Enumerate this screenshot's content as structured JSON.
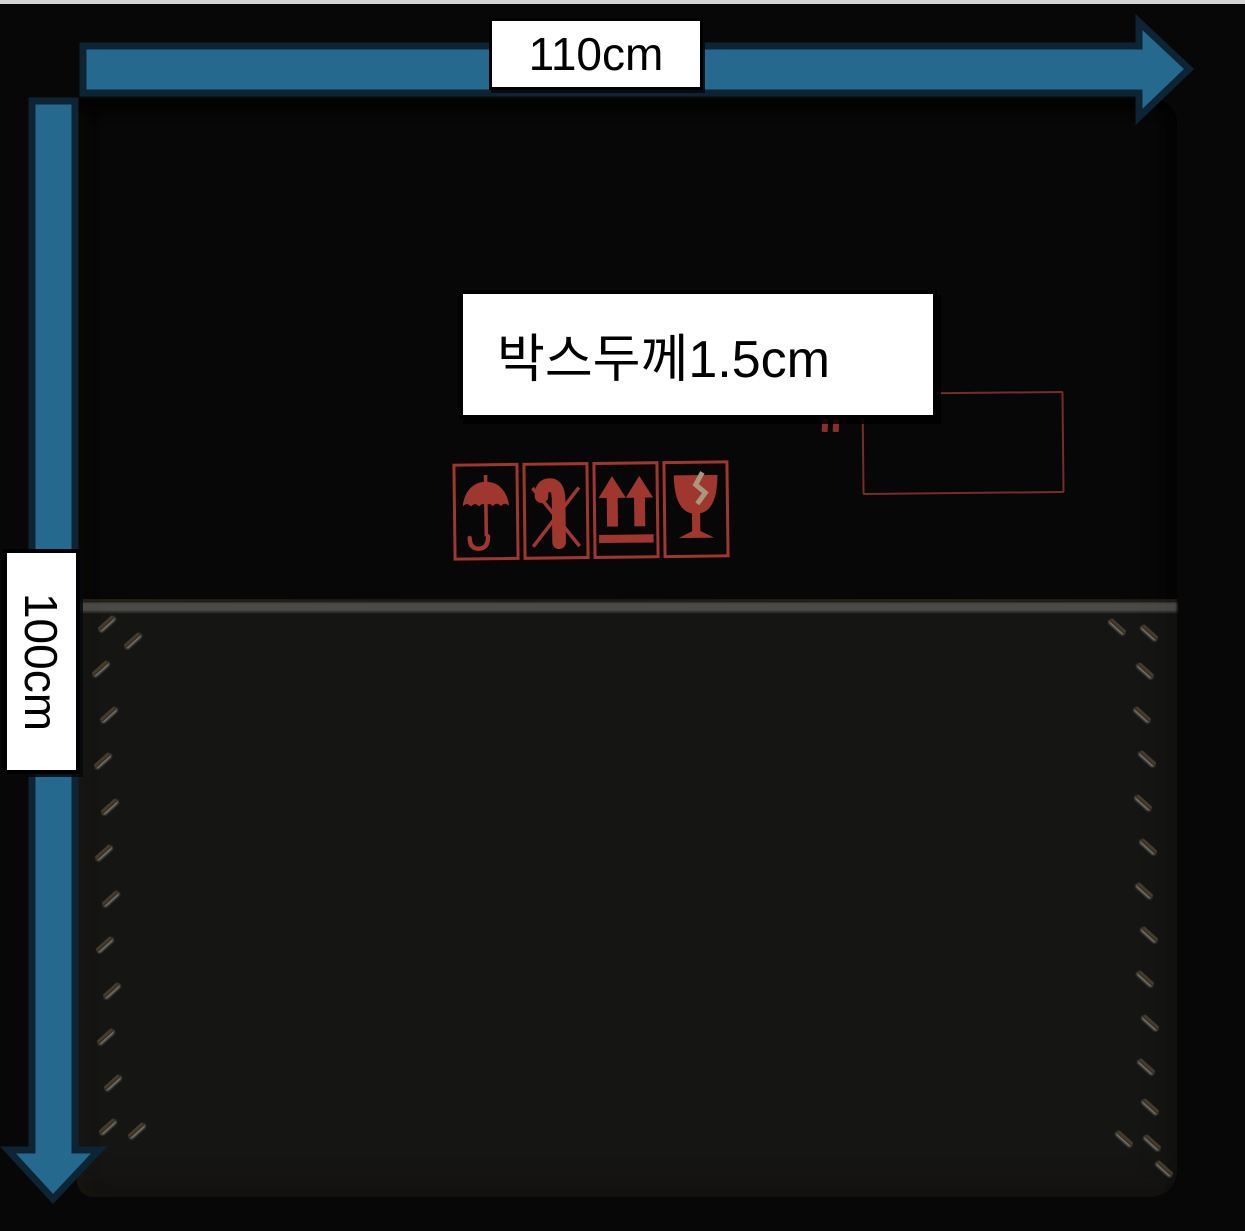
{
  "scene": {
    "description": "Photograph of a kraft cardboard shipping box on a black background, annotated with dimension arrows and measurement labels"
  },
  "annotations": {
    "width_label": "110cm",
    "height_label": "100cm",
    "thickness_label": "박스두께1.5cm"
  },
  "colors": {
    "background": "#070707",
    "top_edge": "#d5d5d5",
    "arrow_fill": "#26698e",
    "arrow_outline": "#0d2435",
    "cardboard": "#b2a48a",
    "print_red": "#ab3b31",
    "label_bg": "#ffffff",
    "label_border": "#000000",
    "label_text": "#000000"
  },
  "box": {
    "printed_icons": [
      {
        "name": "keep-dry-umbrella-icon"
      },
      {
        "name": "no-hooks-icon"
      },
      {
        "name": "this-way-up-icon"
      },
      {
        "name": "fragile-glass-icon"
      }
    ],
    "stitch_marks": {
      "left": {
        "angle": -42,
        "points": [
          [
            19,
            522
          ],
          [
            13,
            567
          ],
          [
            21,
            613
          ],
          [
            15,
            659
          ],
          [
            22,
            705
          ],
          [
            16,
            751
          ],
          [
            23,
            797
          ],
          [
            17,
            843
          ],
          [
            24,
            889
          ],
          [
            18,
            935
          ],
          [
            25,
            981
          ],
          [
            20,
            1025
          ],
          [
            49,
            1029
          ],
          [
            45,
            539
          ]
        ]
      },
      "right": {
        "angle": 42,
        "points": [
          [
            1031,
            525
          ],
          [
            1063,
            531
          ],
          [
            1059,
            569
          ],
          [
            1056,
            613
          ],
          [
            1061,
            657
          ],
          [
            1057,
            701
          ],
          [
            1062,
            745
          ],
          [
            1058,
            789
          ],
          [
            1063,
            833
          ],
          [
            1059,
            877
          ],
          [
            1064,
            921
          ],
          [
            1060,
            965
          ],
          [
            1064,
            1005
          ],
          [
            1038,
            1037
          ],
          [
            1066,
            1041
          ],
          [
            1078,
            1067
          ]
        ]
      }
    }
  }
}
